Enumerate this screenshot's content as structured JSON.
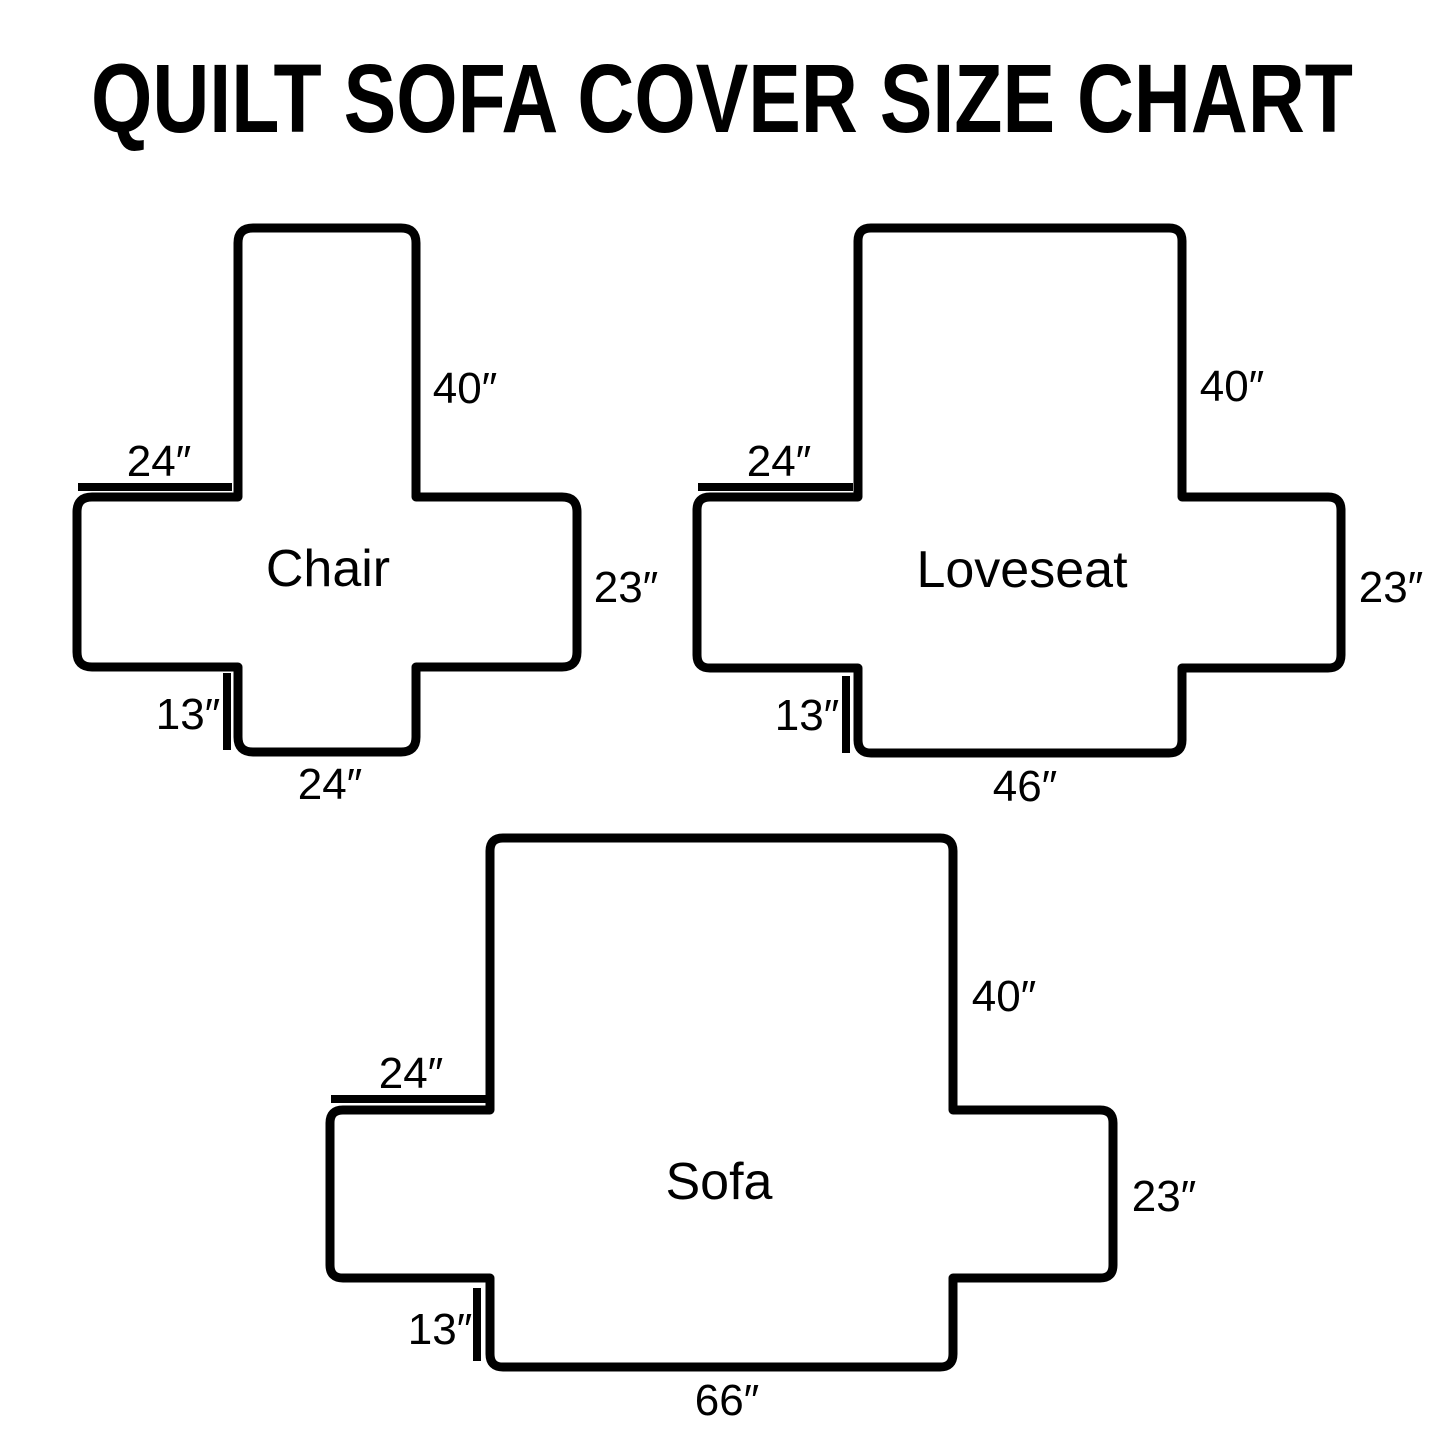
{
  "title": "QUILT SOFA COVER SIZE CHART",
  "colors": {
    "line": "#000000",
    "background": "#ffffff",
    "text": "#000000"
  },
  "diagrams": [
    {
      "name": "Chair",
      "back_height": "40″",
      "arm_top_width": "24″",
      "side_height": "23″",
      "front_height": "13″",
      "bottom_width": "24″"
    },
    {
      "name": "Loveseat",
      "back_height": "40″",
      "arm_top_width": "24″",
      "side_height": "23″",
      "front_height": "13″",
      "bottom_width": "46″"
    },
    {
      "name": "Sofa",
      "back_height": "40″",
      "arm_top_width": "24″",
      "side_height": "23″",
      "front_height": "13″",
      "bottom_width": "66″"
    }
  ]
}
